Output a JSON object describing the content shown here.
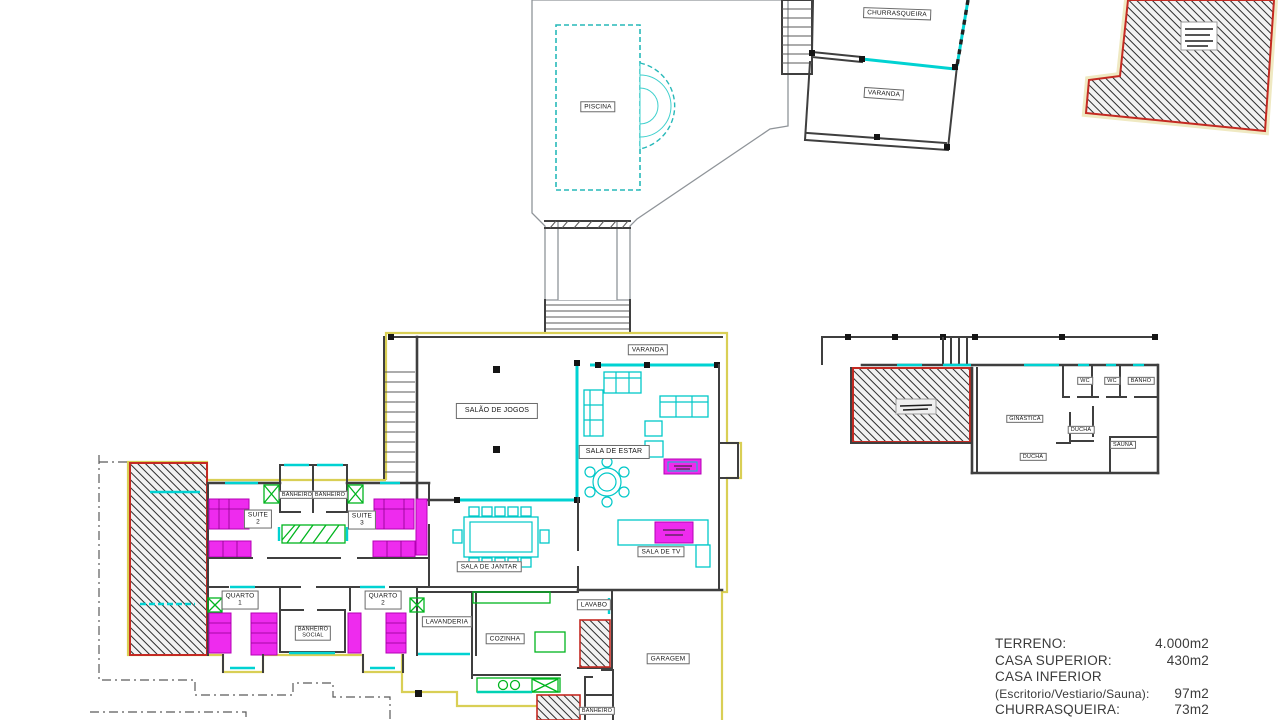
{
  "rooms": {
    "piscina": "PISCINA",
    "churrasqueira": "CHURRASQUEIRA",
    "varanda_churrasqueira": "VARANDA",
    "varanda": "VARANDA",
    "salao_de_jogos": "SALÃO DE JOGOS",
    "sala_de_estar": "SALA DE ESTAR",
    "sala_de_jantar": "SALA DE JANTAR",
    "sala_de_tv": "SALA DE TV",
    "suite2": "SUITE\n2",
    "suite3": "SUITE\n3",
    "banheiro_suite2": "BANHEIRO",
    "banheiro_suite3": "BANHEIRO",
    "quarto1": "QUARTO\n1",
    "quarto2": "QUARTO\n2",
    "banheiro_social": "BANHEIRO\nSOCIAL",
    "lavanderia": "LAVANDERIA",
    "cozinha": "COZINHA",
    "lavabo": "LAVABO",
    "garagem": "GARAGEM",
    "banheiro_inferior": "BANHEIRO",
    "wc1": "WC",
    "wc2": "WC",
    "banho": "BANHO",
    "ginastica": "GINASTICA",
    "ducha1": "DUCHA",
    "ducha2": "DUCHA",
    "sauna": "SAUNA"
  },
  "legend": {
    "rows": [
      {
        "label": "TERRENO:",
        "value": "4.000m2"
      },
      {
        "label": "CASA SUPERIOR:",
        "value": "430m2"
      },
      {
        "label": "CASA INFERIOR",
        "value": ""
      },
      {
        "label": "(Escritorio/Vestiario/Sauna):",
        "value": "97m2"
      },
      {
        "label": "CHURRASQUEIRA:",
        "value": "73m2"
      }
    ]
  },
  "colors": {
    "wall": "#3f3f3f",
    "glass_cyan": "#00d2d2",
    "furniture_magenta": "#ee2bee",
    "furniture_green": "#00b51e",
    "roof_yellow": "#d9cf55",
    "hatch_border_red": "#c42a22"
  }
}
